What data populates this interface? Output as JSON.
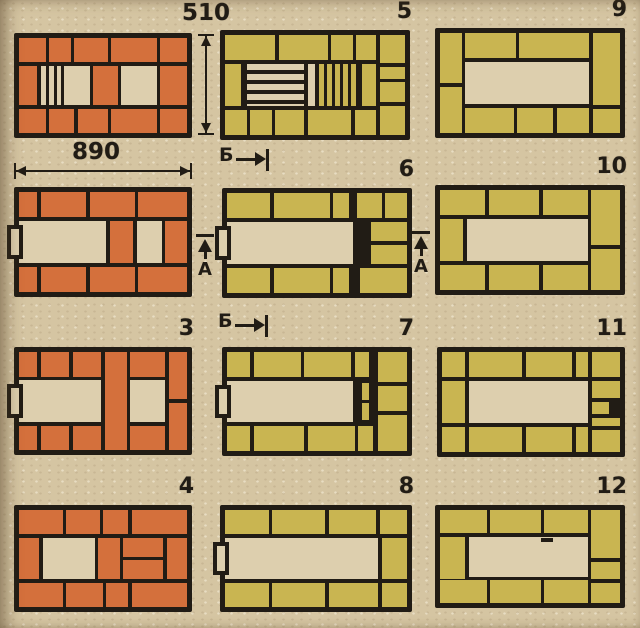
{
  "colors": {
    "brick_orange": "#d4703c",
    "brick_yellow": "#c9b551",
    "paper": "#ddcfae",
    "line": "#211c15",
    "background": "#d5c5a2"
  },
  "annotations": {
    "dim_height": {
      "label": "510"
    },
    "dim_width": {
      "label": "890"
    },
    "section_b_top": {
      "label": "Б"
    },
    "section_b_bottom": {
      "label": "Б"
    },
    "section_a_left": {
      "label": "А"
    },
    "section_a_right": {
      "label": "А"
    }
  },
  "courses": [
    {
      "name": "course-plan-1",
      "number": "",
      "color": "orange",
      "grate": "paper",
      "pos": [
        14,
        33,
        178,
        105
      ],
      "cells": [
        [
          "b",
          0,
          0,
          16,
          25
        ],
        [
          "b",
          18,
          0,
          13,
          25
        ],
        [
          "b",
          33,
          0,
          20,
          25
        ],
        [
          "b",
          55,
          0,
          27,
          25
        ],
        [
          "b",
          84,
          0,
          16,
          25
        ],
        [
          "b",
          0,
          29,
          11,
          42
        ],
        [
          "g",
          13,
          29,
          12,
          42
        ],
        [
          "v",
          27,
          29,
          15,
          42
        ],
        [
          "b",
          44,
          29,
          15,
          42
        ],
        [
          "v",
          61,
          29,
          21,
          42
        ],
        [
          "b",
          84,
          29,
          16,
          42
        ],
        [
          "b",
          0,
          75,
          16,
          25
        ],
        [
          "b",
          18,
          75,
          15,
          25
        ],
        [
          "b",
          35,
          75,
          18,
          25
        ],
        [
          "b",
          55,
          75,
          27,
          25
        ],
        [
          "b",
          84,
          75,
          16,
          25
        ]
      ]
    },
    {
      "name": "course-plan-2",
      "number": "",
      "color": "orange",
      "grate": "paper",
      "pos": [
        14,
        187,
        178,
        110
      ],
      "cells": [
        [
          "b",
          0,
          0,
          11,
          25
        ],
        [
          "b",
          13,
          0,
          27,
          25
        ],
        [
          "b",
          42,
          0,
          27,
          25
        ],
        [
          "b",
          71,
          0,
          29,
          25
        ],
        [
          "v",
          0,
          29,
          52,
          42
        ],
        [
          "b",
          54,
          29,
          14,
          42
        ],
        [
          "v",
          70,
          29,
          15,
          42
        ],
        [
          "b",
          87,
          29,
          13,
          42
        ],
        [
          "d",
          -12,
          33,
          16,
          34
        ],
        [
          "b",
          0,
          75,
          11,
          25
        ],
        [
          "b",
          13,
          75,
          27,
          25
        ],
        [
          "b",
          42,
          75,
          27,
          25
        ],
        [
          "b",
          71,
          75,
          29,
          25
        ]
      ]
    },
    {
      "name": "course-plan-3",
      "number": "3",
      "color": "orange",
      "grate": "paper",
      "pos": [
        14,
        347,
        178,
        108
      ],
      "cells": [
        [
          "b",
          0,
          0,
          11,
          25
        ],
        [
          "b",
          13,
          0,
          17,
          25
        ],
        [
          "b",
          32,
          0,
          17,
          25
        ],
        [
          "b",
          51,
          0,
          13,
          100
        ],
        [
          "b",
          66,
          0,
          21,
          25
        ],
        [
          "b",
          89,
          0,
          11,
          48
        ],
        [
          "b",
          89,
          52,
          11,
          48
        ],
        [
          "v",
          0,
          29,
          49,
          42
        ],
        [
          "v",
          66,
          29,
          21,
          42
        ],
        [
          "d",
          -12,
          33,
          16,
          34
        ],
        [
          "b",
          0,
          75,
          11,
          25
        ],
        [
          "b",
          13,
          75,
          17,
          25
        ],
        [
          "b",
          32,
          75,
          17,
          25
        ],
        [
          "b",
          66,
          75,
          21,
          25
        ]
      ]
    },
    {
      "name": "course-plan-4",
      "number": "4",
      "color": "orange",
      "grate": "paper",
      "pos": [
        14,
        505,
        178,
        107
      ],
      "cells": [
        [
          "b",
          0,
          0,
          26,
          25
        ],
        [
          "b",
          28,
          0,
          20,
          25
        ],
        [
          "b",
          50,
          0,
          15,
          25
        ],
        [
          "b",
          67,
          0,
          33,
          25
        ],
        [
          "b",
          0,
          29,
          12,
          42
        ],
        [
          "v",
          14,
          29,
          31,
          42
        ],
        [
          "b",
          47,
          29,
          13,
          42
        ],
        [
          "b",
          62,
          29,
          24,
          19
        ],
        [
          "b",
          62,
          52,
          24,
          19
        ],
        [
          "b",
          88,
          29,
          12,
          42
        ],
        [
          "b",
          0,
          75,
          26,
          25
        ],
        [
          "b",
          28,
          75,
          22,
          25
        ],
        [
          "b",
          52,
          75,
          13,
          25
        ],
        [
          "b",
          67,
          75,
          33,
          25
        ]
      ]
    },
    {
      "name": "course-plan-5",
      "number": "5",
      "color": "yellow",
      "grate": "yellow",
      "pos": [
        220,
        30,
        190,
        110
      ],
      "cells": [
        [
          "b",
          0,
          0,
          28,
          25
        ],
        [
          "b",
          30,
          0,
          27,
          25
        ],
        [
          "b",
          59,
          0,
          12,
          25
        ],
        [
          "b",
          73,
          0,
          11,
          25
        ],
        [
          "b",
          86,
          0,
          14,
          28
        ],
        [
          "b",
          86,
          32,
          14,
          12
        ],
        [
          "b",
          86,
          47,
          14,
          20
        ],
        [
          "b",
          86,
          71,
          14,
          29
        ],
        [
          "b",
          0,
          29,
          9,
          42
        ],
        [
          "c",
          12,
          29,
          32,
          42
        ],
        [
          "v",
          46,
          29,
          4,
          42
        ],
        [
          "g",
          52,
          29,
          22,
          42
        ],
        [
          "b",
          76,
          29,
          8,
          42
        ],
        [
          "b",
          0,
          75,
          12,
          25
        ],
        [
          "b",
          14,
          75,
          12,
          25
        ],
        [
          "b",
          28,
          75,
          16,
          25
        ],
        [
          "b",
          46,
          75,
          24,
          25
        ],
        [
          "b",
          72,
          75,
          12,
          25
        ]
      ]
    },
    {
      "name": "course-plan-6",
      "number": "6",
      "color": "yellow",
      "grate": "yellow",
      "pos": [
        222,
        188,
        190,
        110
      ],
      "cells": [
        [
          "b",
          0,
          0,
          24,
          25
        ],
        [
          "b",
          26,
          0,
          31,
          25
        ],
        [
          "b",
          59,
          0,
          9,
          25
        ],
        [
          "b",
          72,
          0,
          14,
          25
        ],
        [
          "b",
          88,
          0,
          12,
          25
        ],
        [
          "v",
          0,
          29,
          70,
          42
        ],
        [
          "d",
          -12,
          33,
          16,
          34
        ],
        [
          "l",
          72,
          29,
          2,
          42
        ],
        [
          "l",
          76,
          29,
          2,
          42
        ],
        [
          "b",
          80,
          29,
          20,
          19
        ],
        [
          "b",
          80,
          52,
          20,
          19
        ],
        [
          "b",
          0,
          75,
          24,
          25
        ],
        [
          "b",
          26,
          75,
          31,
          25
        ],
        [
          "b",
          59,
          75,
          9,
          25
        ],
        [
          "b",
          74,
          75,
          26,
          25
        ]
      ]
    },
    {
      "name": "course-plan-7",
      "number": "7",
      "color": "yellow",
      "grate": "yellow",
      "pos": [
        222,
        347,
        190,
        109
      ],
      "cells": [
        [
          "b",
          0,
          0,
          13,
          25
        ],
        [
          "b",
          15,
          0,
          26,
          25
        ],
        [
          "b",
          43,
          0,
          26,
          25
        ],
        [
          "b",
          71,
          0,
          8,
          25
        ],
        [
          "b",
          84,
          0,
          16,
          30
        ],
        [
          "b",
          84,
          34,
          16,
          26
        ],
        [
          "b",
          84,
          64,
          16,
          36
        ],
        [
          "v",
          0,
          29,
          70,
          42
        ],
        [
          "d",
          -12,
          33,
          16,
          34
        ],
        [
          "l",
          72,
          29,
          2,
          42
        ],
        [
          "l",
          80,
          29,
          2,
          42
        ],
        [
          "b",
          75,
          31,
          4,
          17
        ],
        [
          "b",
          75,
          52,
          4,
          17
        ],
        [
          "b",
          0,
          75,
          13,
          25
        ],
        [
          "b",
          15,
          75,
          28,
          25
        ],
        [
          "b",
          45,
          75,
          26,
          25
        ],
        [
          "b",
          73,
          75,
          8,
          25
        ]
      ]
    },
    {
      "name": "course-plan-8",
      "number": "8",
      "color": "yellow",
      "grate": "yellow",
      "pos": [
        220,
        505,
        192,
        107
      ],
      "cells": [
        [
          "b",
          0,
          0,
          24,
          25
        ],
        [
          "b",
          26,
          0,
          29,
          25
        ],
        [
          "b",
          57,
          0,
          26,
          25
        ],
        [
          "b",
          85,
          0,
          15,
          25
        ],
        [
          "v",
          0,
          29,
          84,
          42
        ],
        [
          "d",
          -12,
          33,
          16,
          34
        ],
        [
          "b",
          86,
          29,
          14,
          42
        ],
        [
          "b",
          0,
          75,
          24,
          25
        ],
        [
          "b",
          26,
          75,
          29,
          25
        ],
        [
          "b",
          57,
          75,
          27,
          25
        ],
        [
          "b",
          86,
          75,
          14,
          25
        ]
      ]
    },
    {
      "name": "course-plan-9",
      "number": "9",
      "color": "yellow",
      "grate": "yellow",
      "pos": [
        435,
        28,
        190,
        110
      ],
      "cells": [
        [
          "b",
          0,
          0,
          12,
          50
        ],
        [
          "b",
          0,
          54,
          12,
          46
        ],
        [
          "b",
          14,
          0,
          28,
          25
        ],
        [
          "b",
          44,
          0,
          39,
          25
        ],
        [
          "b",
          85,
          0,
          15,
          72
        ],
        [
          "b",
          85,
          76,
          15,
          24
        ],
        [
          "v",
          14,
          29,
          69,
          42
        ],
        [
          "b",
          14,
          75,
          27,
          25
        ],
        [
          "b",
          43,
          75,
          20,
          25
        ],
        [
          "b",
          65,
          75,
          18,
          25
        ]
      ]
    },
    {
      "name": "course-plan-10",
      "number": "10",
      "color": "yellow",
      "grate": "yellow",
      "pos": [
        435,
        185,
        190,
        110
      ],
      "cells": [
        [
          "b",
          0,
          0,
          25,
          25
        ],
        [
          "b",
          27,
          0,
          28,
          25
        ],
        [
          "b",
          57,
          0,
          25,
          25
        ],
        [
          "b",
          84,
          0,
          16,
          55
        ],
        [
          "b",
          84,
          59,
          16,
          41
        ],
        [
          "b",
          0,
          29,
          13,
          42
        ],
        [
          "v",
          15,
          29,
          67,
          42
        ],
        [
          "b",
          0,
          75,
          25,
          25
        ],
        [
          "b",
          27,
          75,
          28,
          25
        ],
        [
          "b",
          57,
          75,
          25,
          25
        ]
      ]
    },
    {
      "name": "course-plan-11",
      "number": "11",
      "color": "yellow",
      "grate": "yellow",
      "pos": [
        437,
        347,
        188,
        110
      ],
      "cells": [
        [
          "b",
          0,
          0,
          13,
          25
        ],
        [
          "b",
          15,
          0,
          30,
          25
        ],
        [
          "b",
          47,
          0,
          26,
          25
        ],
        [
          "b",
          75,
          0,
          7,
          25
        ],
        [
          "b",
          84,
          0,
          16,
          25
        ],
        [
          "b",
          84,
          29,
          16,
          17
        ],
        [
          "b",
          84,
          50,
          10,
          12
        ],
        [
          "b",
          84,
          66,
          16,
          8
        ],
        [
          "b",
          84,
          78,
          16,
          22
        ],
        [
          "b",
          0,
          29,
          13,
          42
        ],
        [
          "v",
          15,
          29,
          67,
          42
        ],
        [
          "b",
          0,
          75,
          13,
          25
        ],
        [
          "b",
          15,
          75,
          30,
          25
        ],
        [
          "b",
          47,
          75,
          26,
          25
        ],
        [
          "b",
          75,
          75,
          7,
          25
        ]
      ]
    },
    {
      "name": "course-plan-12",
      "number": "12",
      "color": "yellow",
      "grate": "yellow",
      "pos": [
        435,
        505,
        190,
        103
      ],
      "cells": [
        [
          "b",
          0,
          0,
          26,
          25
        ],
        [
          "b",
          28,
          0,
          28,
          25
        ],
        [
          "b",
          58,
          0,
          24,
          25
        ],
        [
          "b",
          84,
          0,
          16,
          52
        ],
        [
          "b",
          84,
          56,
          16,
          18
        ],
        [
          "b",
          84,
          78,
          16,
          22
        ],
        [
          "b",
          0,
          29,
          14,
          45
        ],
        [
          "v",
          16,
          29,
          66,
          43
        ],
        [
          "l",
          56,
          30,
          7,
          4
        ],
        [
          "b",
          0,
          75,
          26,
          25
        ],
        [
          "b",
          28,
          75,
          28,
          25
        ],
        [
          "b",
          58,
          75,
          24,
          25
        ]
      ]
    }
  ]
}
